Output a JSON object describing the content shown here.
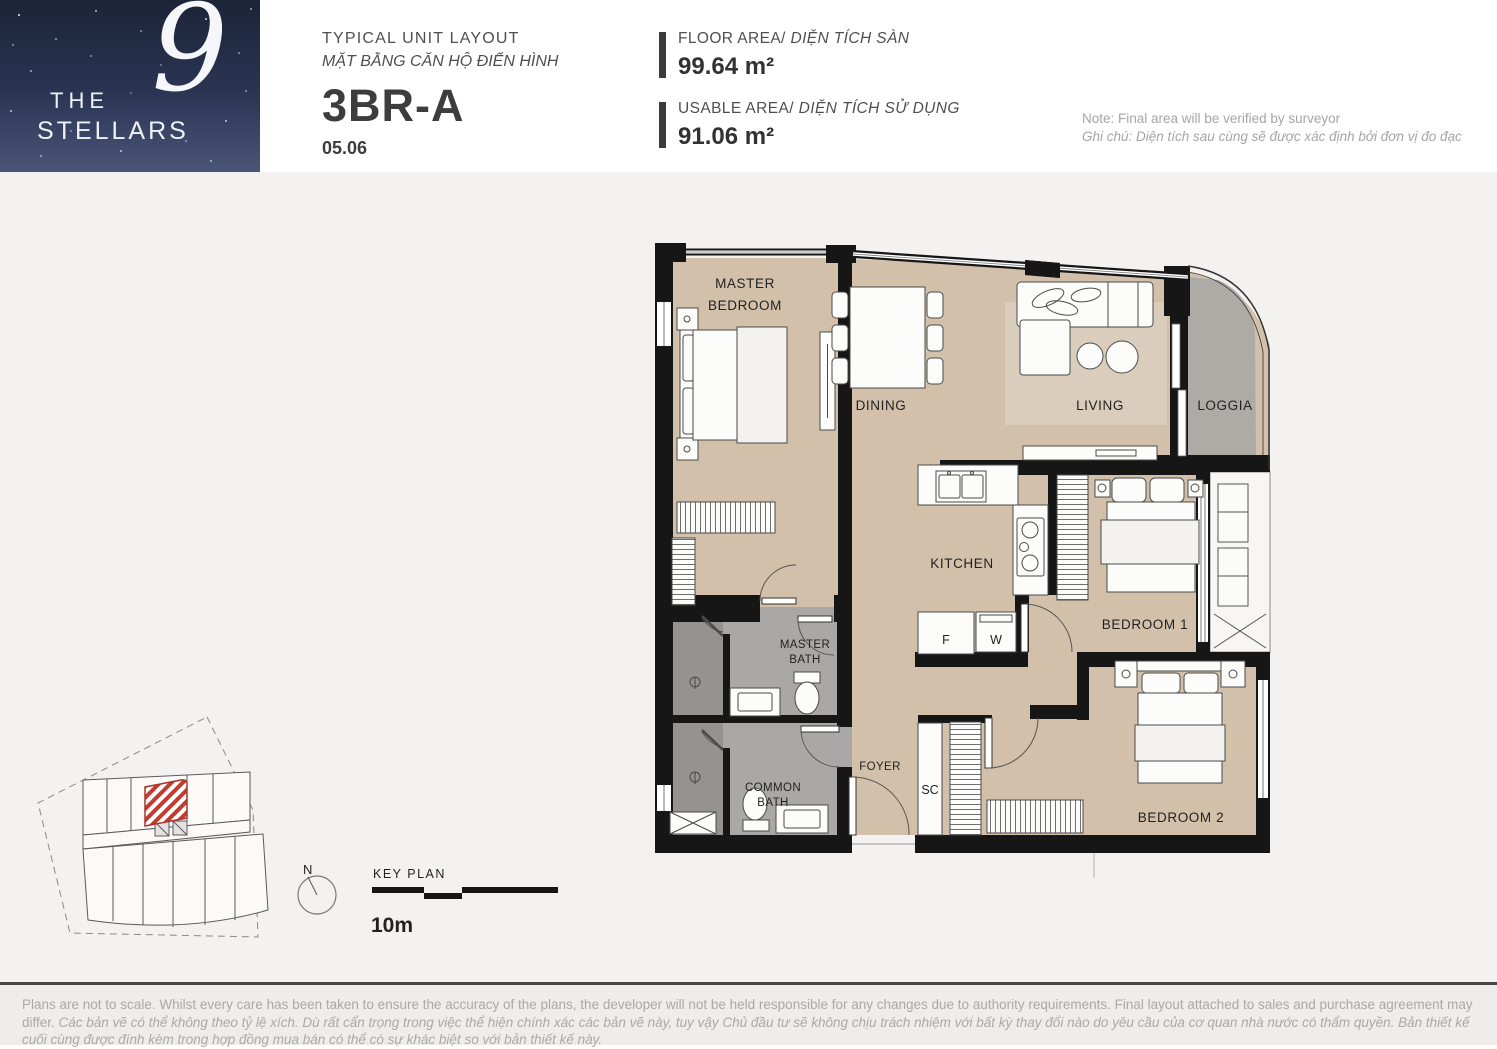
{
  "logo": {
    "the": "THE",
    "nine": "9",
    "stellars": "STELLARS"
  },
  "header": {
    "title_en": "TYPICAL UNIT LAYOUT",
    "title_vi": "MẶT BẰNG CĂN HỘ ĐIỂN HÌNH",
    "unit_code": "3BR-A",
    "unit_number": "05.06"
  },
  "areas": {
    "floor_label_en": "FLOOR AREA/",
    "floor_label_vi": " DIỆN TÍCH SÀN",
    "floor_value": "99.64 m²",
    "usable_label_en": "USABLE AREA/",
    "usable_label_vi": " DIỆN TÍCH SỬ DỤNG",
    "usable_value": "91.06 m²",
    "note_en": "Note: Final area will be verified by surveyor",
    "note_vi": "Ghi chú: Diện tích sau cùng sẽ được xác định bởi đơn vị đo đạc"
  },
  "plan": {
    "labels": {
      "master_bedroom_1": "MASTER",
      "master_bedroom_2": "BEDROOM",
      "dining": "DINING",
      "living": "LIVING",
      "loggia": "LOGGIA",
      "kitchen": "KITCHEN",
      "master_bath_1": "MASTER",
      "master_bath_2": "BATH",
      "common_bath_1": "COMMON",
      "common_bath_2": "BATH",
      "foyer": "FOYER",
      "shoe_cabinet": "SC",
      "fridge": "F",
      "washer": "W",
      "bedroom1": "BEDROOM 1",
      "bedroom2": "BEDROOM 2"
    }
  },
  "key_plan": {
    "north": "N",
    "label": "KEY PLAN",
    "scale": "10m"
  },
  "footer": {
    "disclaimer_en": "Plans are not to scale. Whilst every care has been taken to ensure the accuracy of the plans, the developer will not be held responsible for any changes due to authority requirements. Final layout attached to sales and purchase agreement may differ. ",
    "disclaimer_vi": "Các bản vẽ có thể không theo tỷ lệ xích. Dù rất cẩn trọng trong việc thể hiện chính xác các bản vẽ này, tuy vậy Chủ đầu tư sẽ không chịu trách nhiệm với bất kỳ thay đổi nào do yêu cầu của cơ quan nhà nước có thẩm quyền. Bản thiết kế cuối cùng được đính kèm trong hợp đồng mua bán có thể có sự khác biệt so với bản thiết kế này."
  },
  "colors": {
    "brand_navy": "#1c2438",
    "accent_red": "#b8372b",
    "wall": "#161616",
    "floor": "#d3c0aa",
    "bath": "#a9a8a6",
    "loggia": "#aeaba7"
  }
}
